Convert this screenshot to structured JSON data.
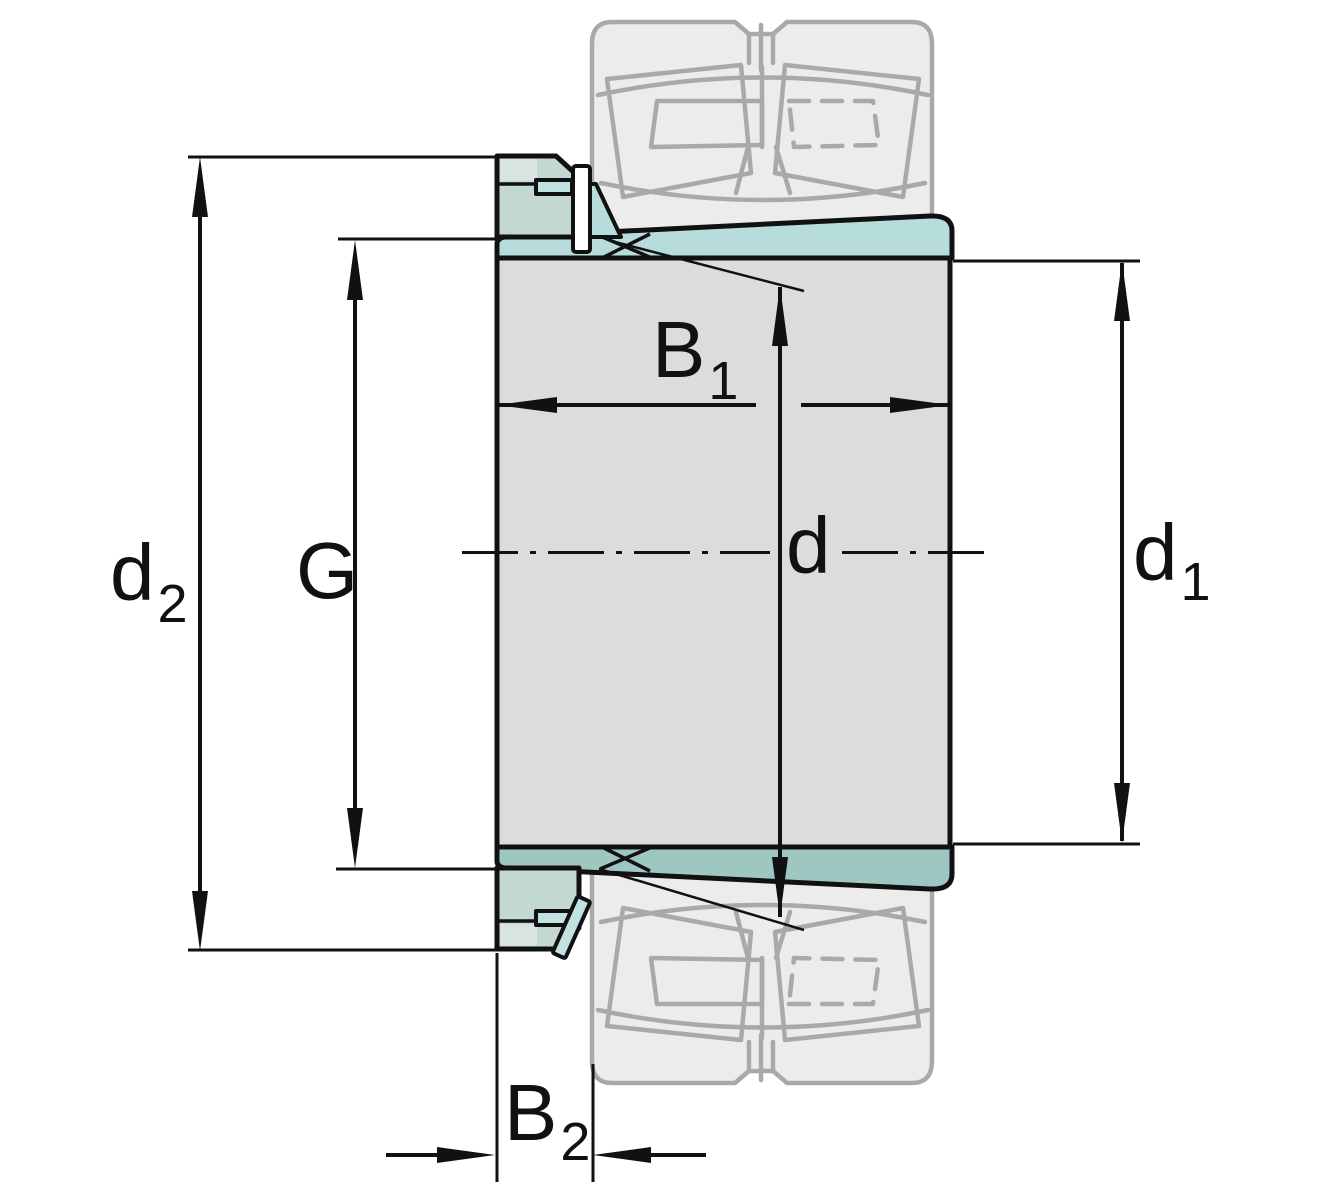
{
  "drawing": {
    "title": "Adapter sleeve with locknut and lock washer, cross-section dimension drawing; spherical roller bearing shown as phantom outline",
    "labels": {
      "d2": {
        "base": "d",
        "sub": "2"
      },
      "g": {
        "base": "G",
        "sub": ""
      },
      "b1": {
        "base": "B",
        "sub": "1"
      },
      "d": {
        "base": "d",
        "sub": ""
      },
      "d1": {
        "base": "d",
        "sub": "1"
      },
      "b2": {
        "base": "B",
        "sub": "2"
      }
    },
    "colors": {
      "line": "#111111",
      "body_fill": "#dcdcdc",
      "sleeve_upper_fill": "#b6dcdb",
      "sleeve_lower_fill": "#9ec7c1",
      "nut_fill": "#c3d8d2",
      "nut_highlight_fill": "#d7e4df",
      "washer_fill": "#c2e2e2",
      "washer_inner_fill": "#ffffff",
      "phantom_fill": "#ececec",
      "phantom_stroke": "#a9a9a9",
      "background": "#ffffff"
    }
  }
}
